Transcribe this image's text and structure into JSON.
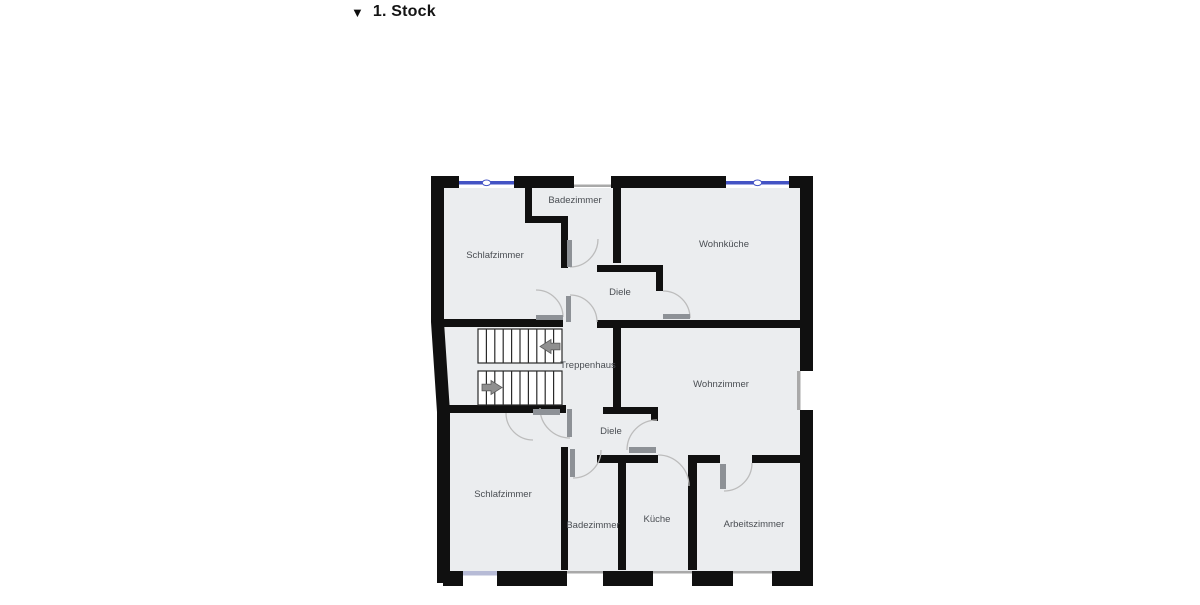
{
  "title": {
    "marker": "▼",
    "label": "1. Stock"
  },
  "floorplan": {
    "rooms": [
      {
        "id": "badezimmer-top",
        "label": "Badezimmer"
      },
      {
        "id": "schlafzimmer-top",
        "label": "Schlafzimmer"
      },
      {
        "id": "wohnkueche",
        "label": "Wohnküche"
      },
      {
        "id": "diele-top",
        "label": "Diele"
      },
      {
        "id": "treppenhaus",
        "label": "Treppenhaus"
      },
      {
        "id": "wohnzimmer",
        "label": "Wohnzimmer"
      },
      {
        "id": "diele-bottom",
        "label": "Diele"
      },
      {
        "id": "schlafzimmer-bottom",
        "label": "Schlafzimmer"
      },
      {
        "id": "badezimmer-bottom",
        "label": "Badezimmer"
      },
      {
        "id": "kueche",
        "label": "Küche"
      },
      {
        "id": "arbeitszimmer",
        "label": "Arbeitszimmer"
      }
    ],
    "legend": {
      "stair_direction_up": "arrow-left",
      "stair_direction_down": "arrow-right"
    },
    "colors": {
      "floor": "#ebedef",
      "wall": "#101010",
      "window_blue": "#4353c4",
      "window_lavender": "#b7bbd6",
      "opening_gray": "#a9a9a9",
      "door_leaf": "#8d9196",
      "door_arc": "#bcbcbc",
      "label_text": "#4a4e53"
    }
  }
}
